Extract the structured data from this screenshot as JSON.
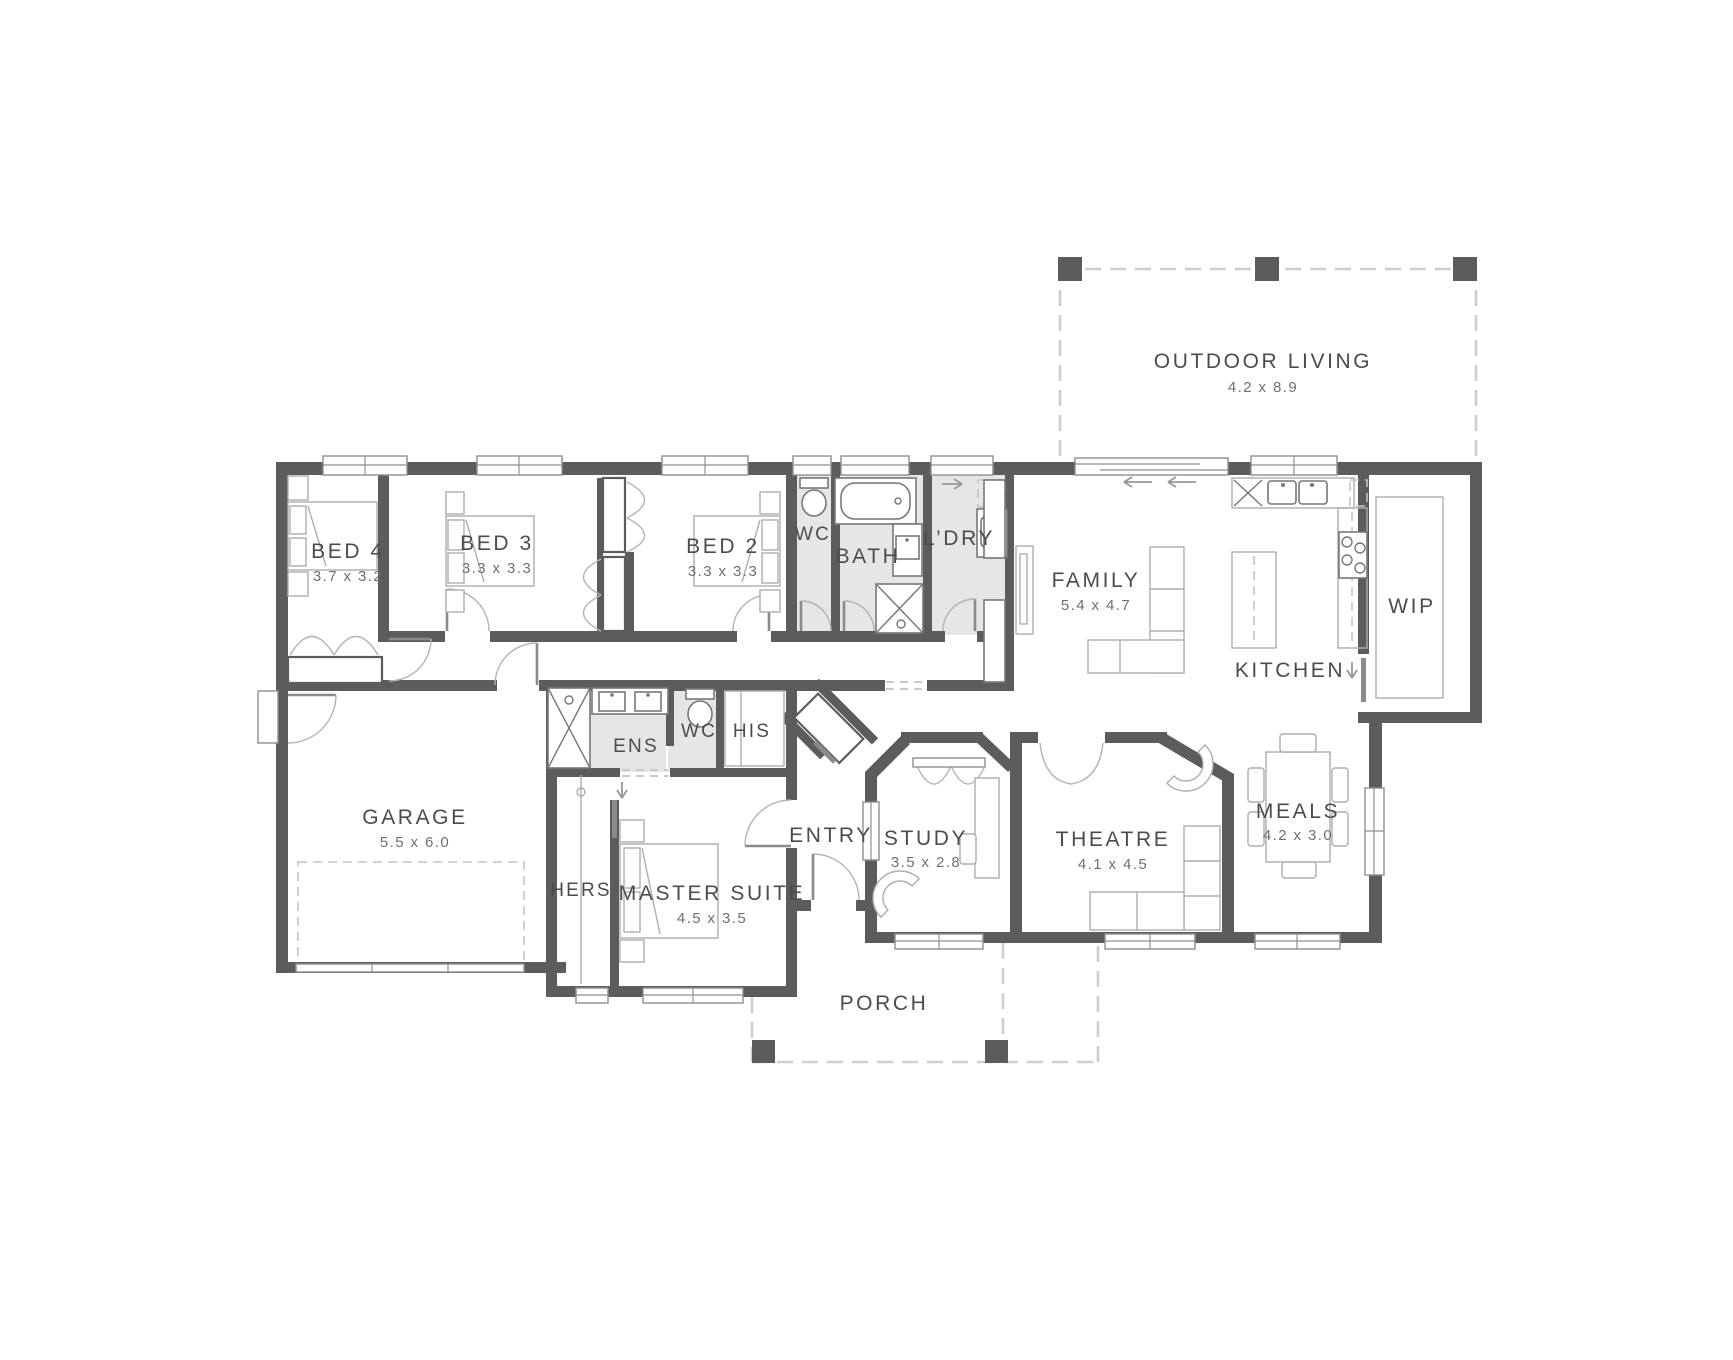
{
  "palette": {
    "background": "#ffffff",
    "wall": "#5c5c5e",
    "wet_area_fill": "#e6e6e7",
    "outline_dash": "#cfcfd1",
    "furniture_stroke": "#aeaeb1",
    "label_text": "#4c4c4e",
    "dims_text": "#6f6f72"
  },
  "plan": {
    "rooms": {
      "outdoor_living": {
        "name": "OUTDOOR LIVING",
        "dims": "4.2 x 8.9"
      },
      "bed4": {
        "name": "BED 4",
        "dims": "3.7 x 3.2"
      },
      "bed3": {
        "name": "BED 3",
        "dims": "3.3 x 3.3"
      },
      "bed2": {
        "name": "BED 2",
        "dims": "3.3 x 3.3"
      },
      "wc_main": {
        "name": "WC"
      },
      "bath": {
        "name": "BATH"
      },
      "laundry": {
        "name": "L’DRY"
      },
      "family": {
        "name": "FAMILY",
        "dims": "5.4 x 4.7"
      },
      "kitchen": {
        "name": "KITCHEN"
      },
      "wip": {
        "name": "WIP"
      },
      "garage": {
        "name": "GARAGE",
        "dims": "5.5 x 6.0"
      },
      "ens": {
        "name": "ENS"
      },
      "wc_ens": {
        "name": "WC"
      },
      "his": {
        "name": "HIS"
      },
      "hers": {
        "name": "HERS"
      },
      "master": {
        "name": "MASTER SUITE",
        "dims": "4.5 x 3.5"
      },
      "entry": {
        "name": "ENTRY"
      },
      "study": {
        "name": "STUDY",
        "dims": "3.5 x 2.8"
      },
      "theatre": {
        "name": "THEATRE",
        "dims": "4.1 x 4.5"
      },
      "meals": {
        "name": "MEALS",
        "dims": "4.2 x 3.0"
      },
      "porch": {
        "name": "PORCH"
      }
    }
  }
}
